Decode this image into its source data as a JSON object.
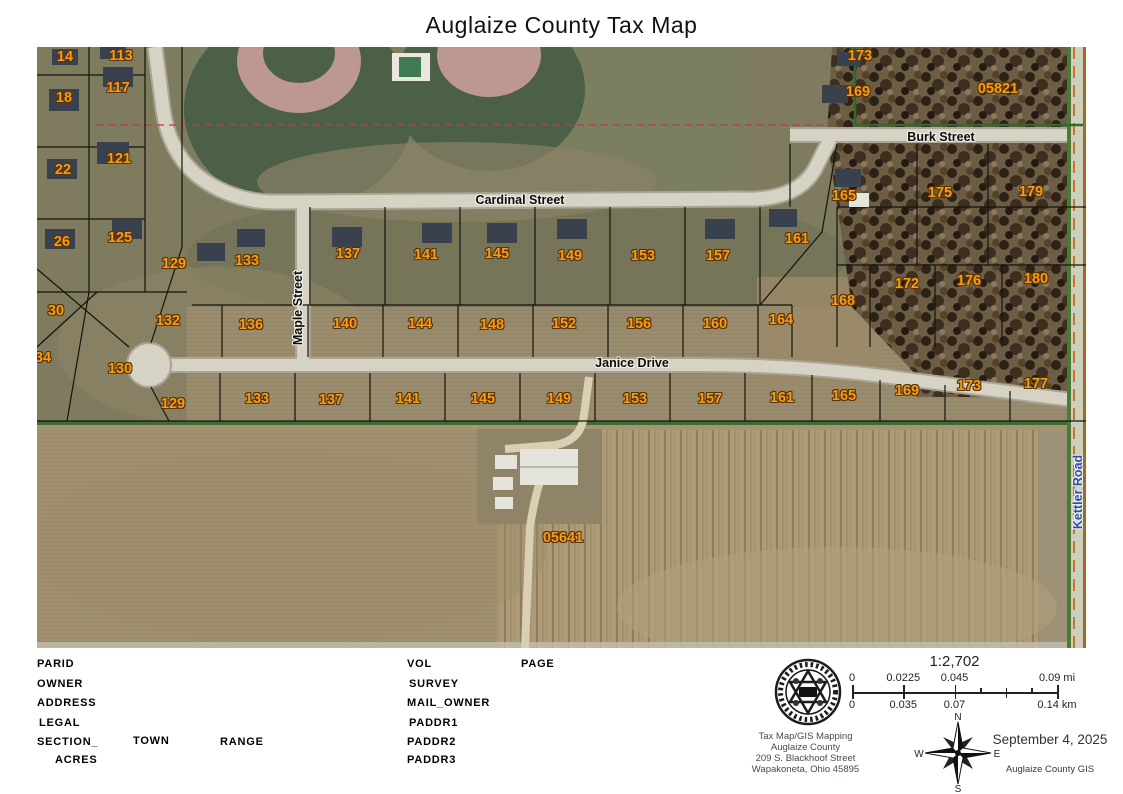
{
  "title": "Auglaize County Tax Map",
  "colors": {
    "parcel_label": "#f79b18",
    "parcel_outline": "#5a3404",
    "street_label": "#0c0c0c",
    "kettler_label_blue": "#2b4fb0",
    "field_tan": "#a5946f",
    "suburb_green": "#7e7b5e"
  },
  "map": {
    "parcels": [
      {
        "text": "14",
        "x": 28,
        "y": 10
      },
      {
        "text": "113",
        "x": 84,
        "y": 9
      },
      {
        "text": "18",
        "x": 27,
        "y": 51
      },
      {
        "text": "117",
        "x": 81,
        "y": 41
      },
      {
        "text": "22",
        "x": 26,
        "y": 123
      },
      {
        "text": "121",
        "x": 82,
        "y": 112
      },
      {
        "text": "26",
        "x": 25,
        "y": 195
      },
      {
        "text": "125",
        "x": 83,
        "y": 191
      },
      {
        "text": "129",
        "x": 137,
        "y": 217
      },
      {
        "text": "133",
        "x": 210,
        "y": 214
      },
      {
        "text": "30",
        "x": 19,
        "y": 264
      },
      {
        "text": "34",
        "x": 6,
        "y": 311
      },
      {
        "text": "132",
        "x": 131,
        "y": 274
      },
      {
        "text": "130",
        "x": 83,
        "y": 322
      },
      {
        "text": "137",
        "x": 311,
        "y": 207
      },
      {
        "text": "141",
        "x": 389,
        "y": 208
      },
      {
        "text": "145",
        "x": 460,
        "y": 207
      },
      {
        "text": "149",
        "x": 533,
        "y": 209
      },
      {
        "text": "153",
        "x": 606,
        "y": 209
      },
      {
        "text": "157",
        "x": 681,
        "y": 209
      },
      {
        "text": "161",
        "x": 760,
        "y": 192
      },
      {
        "text": "165",
        "x": 807,
        "y": 149
      },
      {
        "text": "169",
        "x": 821,
        "y": 45
      },
      {
        "text": "173",
        "x": 823,
        "y": 9
      },
      {
        "text": "05821",
        "x": 961,
        "y": 42
      },
      {
        "text": "175",
        "x": 903,
        "y": 146
      },
      {
        "text": "179",
        "x": 994,
        "y": 145
      },
      {
        "text": "172",
        "x": 870,
        "y": 237
      },
      {
        "text": "176",
        "x": 932,
        "y": 234
      },
      {
        "text": "180",
        "x": 999,
        "y": 232
      },
      {
        "text": "168",
        "x": 806,
        "y": 254
      },
      {
        "text": "164",
        "x": 744,
        "y": 273
      },
      {
        "text": "136",
        "x": 214,
        "y": 278
      },
      {
        "text": "140",
        "x": 308,
        "y": 277
      },
      {
        "text": "144",
        "x": 383,
        "y": 277
      },
      {
        "text": "148",
        "x": 455,
        "y": 278
      },
      {
        "text": "152",
        "x": 527,
        "y": 277
      },
      {
        "text": "156",
        "x": 602,
        "y": 277
      },
      {
        "text": "160",
        "x": 678,
        "y": 277
      },
      {
        "text": "129",
        "x": 136,
        "y": 357
      },
      {
        "text": "133",
        "x": 220,
        "y": 352
      },
      {
        "text": "137",
        "x": 294,
        "y": 353
      },
      {
        "text": "141",
        "x": 371,
        "y": 352
      },
      {
        "text": "145",
        "x": 446,
        "y": 352
      },
      {
        "text": "149",
        "x": 522,
        "y": 352
      },
      {
        "text": "153",
        "x": 598,
        "y": 352
      },
      {
        "text": "157",
        "x": 673,
        "y": 352
      },
      {
        "text": "161",
        "x": 745,
        "y": 351
      },
      {
        "text": "165",
        "x": 807,
        "y": 349
      },
      {
        "text": "169",
        "x": 870,
        "y": 344
      },
      {
        "text": "173",
        "x": 932,
        "y": 339
      },
      {
        "text": "177",
        "x": 999,
        "y": 337
      },
      {
        "text": "05641",
        "x": 526,
        "y": 491
      }
    ],
    "streets": [
      {
        "name": "Cardinal Street",
        "x": 483,
        "y": 153,
        "vert": false,
        "blue": false
      },
      {
        "name": "Burk Street",
        "x": 904,
        "y": 90,
        "vert": false,
        "blue": false
      },
      {
        "name": "Janice Drive",
        "x": 595,
        "y": 316,
        "vert": false,
        "blue": false
      },
      {
        "name": "Maple Street",
        "x": 261,
        "y": 261,
        "vert": true,
        "blue": false
      },
      {
        "name": "Kettler Road",
        "x": 1041,
        "y": 445,
        "vert": true,
        "blue": true
      }
    ]
  },
  "footer": {
    "fields": [
      {
        "label": "PARID",
        "x": 37,
        "y": 658
      },
      {
        "label": "OWNER",
        "x": 37,
        "y": 678
      },
      {
        "label": "ADDRESS",
        "x": 37,
        "y": 697
      },
      {
        "label": "LEGAL",
        "x": 39,
        "y": 717
      },
      {
        "label": "SECTION_",
        "x": 37,
        "y": 736
      },
      {
        "label": "TOWN",
        "x": 133,
        "y": 735
      },
      {
        "label": "RANGE",
        "x": 220,
        "y": 736
      },
      {
        "label": "ACRES",
        "x": 55,
        "y": 754
      },
      {
        "label": "VOL",
        "x": 407,
        "y": 658
      },
      {
        "label": "PAGE",
        "x": 521,
        "y": 658
      },
      {
        "label": "SURVEY",
        "x": 409,
        "y": 678
      },
      {
        "label": "MAIL_OWNER",
        "x": 407,
        "y": 697
      },
      {
        "label": "PADDR1",
        "x": 409,
        "y": 717
      },
      {
        "label": "PADDR2",
        "x": 407,
        "y": 736
      },
      {
        "label": "PADDR3",
        "x": 407,
        "y": 754
      }
    ],
    "scale": {
      "ratio": "1:2,702",
      "mi": [
        {
          "t": "0",
          "p": 0
        },
        {
          "t": "0.0225",
          "p": 0.25
        },
        {
          "t": "0.045",
          "p": 0.5
        },
        {
          "t": "0.09 mi",
          "p": 1
        }
      ],
      "km": [
        {
          "t": "0",
          "p": 0
        },
        {
          "t": "0.035",
          "p": 0.25
        },
        {
          "t": "0.07",
          "p": 0.5
        },
        {
          "t": "0.14 km",
          "p": 1
        }
      ]
    },
    "org": {
      "line1": "Tax Map/GIS Mapping",
      "line2": "Auglaize County",
      "line3": "209 S. Blackhoof Street",
      "line4": "Wapakoneta, Ohio 45895"
    },
    "compass": {
      "n": "N",
      "e": "E",
      "s": "S",
      "w": "W"
    },
    "date": "September 4, 2025",
    "credit": "Auglaize County GIS"
  }
}
